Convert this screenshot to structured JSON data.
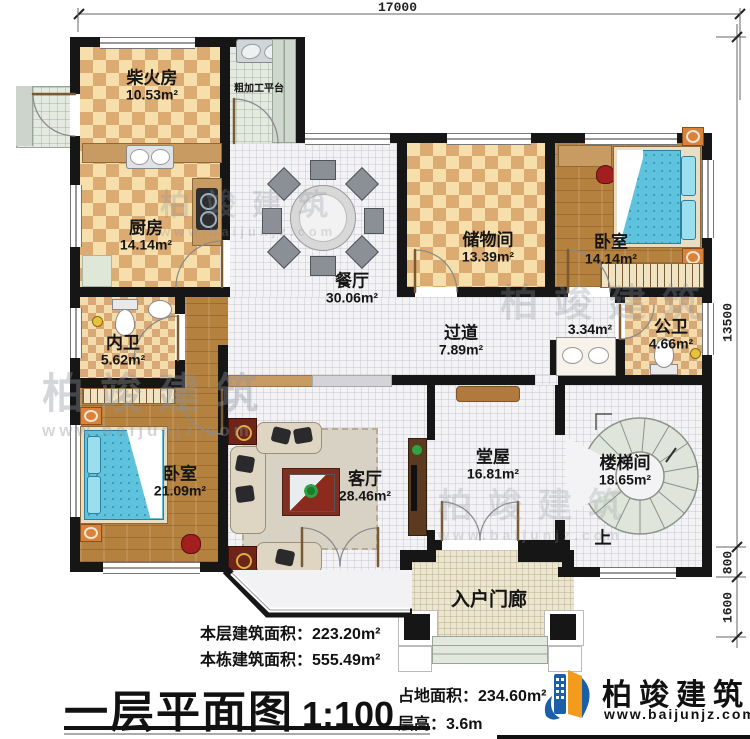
{
  "dims": {
    "top": "17000",
    "right": "13500",
    "r800": "800",
    "r1600": "1600"
  },
  "rooms": {
    "firewood": {
      "name": "柴火房",
      "area": "10.53m²"
    },
    "platform": {
      "name": "粗加工平台"
    },
    "kitchen": {
      "name": "厨房",
      "area": "14.14m²"
    },
    "dining": {
      "name": "餐厅",
      "area": "30.06m²"
    },
    "storage": {
      "name": "储物间",
      "area": "13.39m²"
    },
    "bedroom1": {
      "name": "卧室",
      "area": "14.14m²"
    },
    "corridor": {
      "name": "过道",
      "area": "7.89m²"
    },
    "basin": {
      "area": "3.34m²"
    },
    "pubbath": {
      "name": "公卫",
      "area": "4.66m²"
    },
    "privbath": {
      "name": "内卫",
      "area": "5.62m²"
    },
    "bedroom2": {
      "name": "卧室",
      "area": "21.09m²"
    },
    "living": {
      "name": "客厅",
      "area": "28.46m²"
    },
    "hall": {
      "name": "堂屋",
      "area": "16.81m²"
    },
    "stair": {
      "name": "楼梯间",
      "area": "18.65m²"
    },
    "porch": {
      "name": "入户门廊"
    },
    "up_label": "上"
  },
  "stats": {
    "floor_area_label": "本层建筑面积：",
    "floor_area_value": "223.20m²",
    "total_area_label": "本栋建筑面积：",
    "total_area_value": "555.49m²",
    "land_label": "占地面积：",
    "land_value": "234.60m²",
    "height_label": "层高：",
    "height_value": "3.6m"
  },
  "title": {
    "main": "一层平面图",
    "scale": "1:100"
  },
  "brand": {
    "name": "柏竣建筑",
    "url": "www.baijunjz.com"
  },
  "watermark": {
    "text": "柏竣建筑",
    "url": "www.baijunjz.com"
  },
  "colors": {
    "wall": "#161616",
    "brand_blue": "#1a5fa8",
    "brand_orange": "#f29b1d",
    "bed": "#5fc3dd",
    "accent_red": "#a11f1f"
  }
}
